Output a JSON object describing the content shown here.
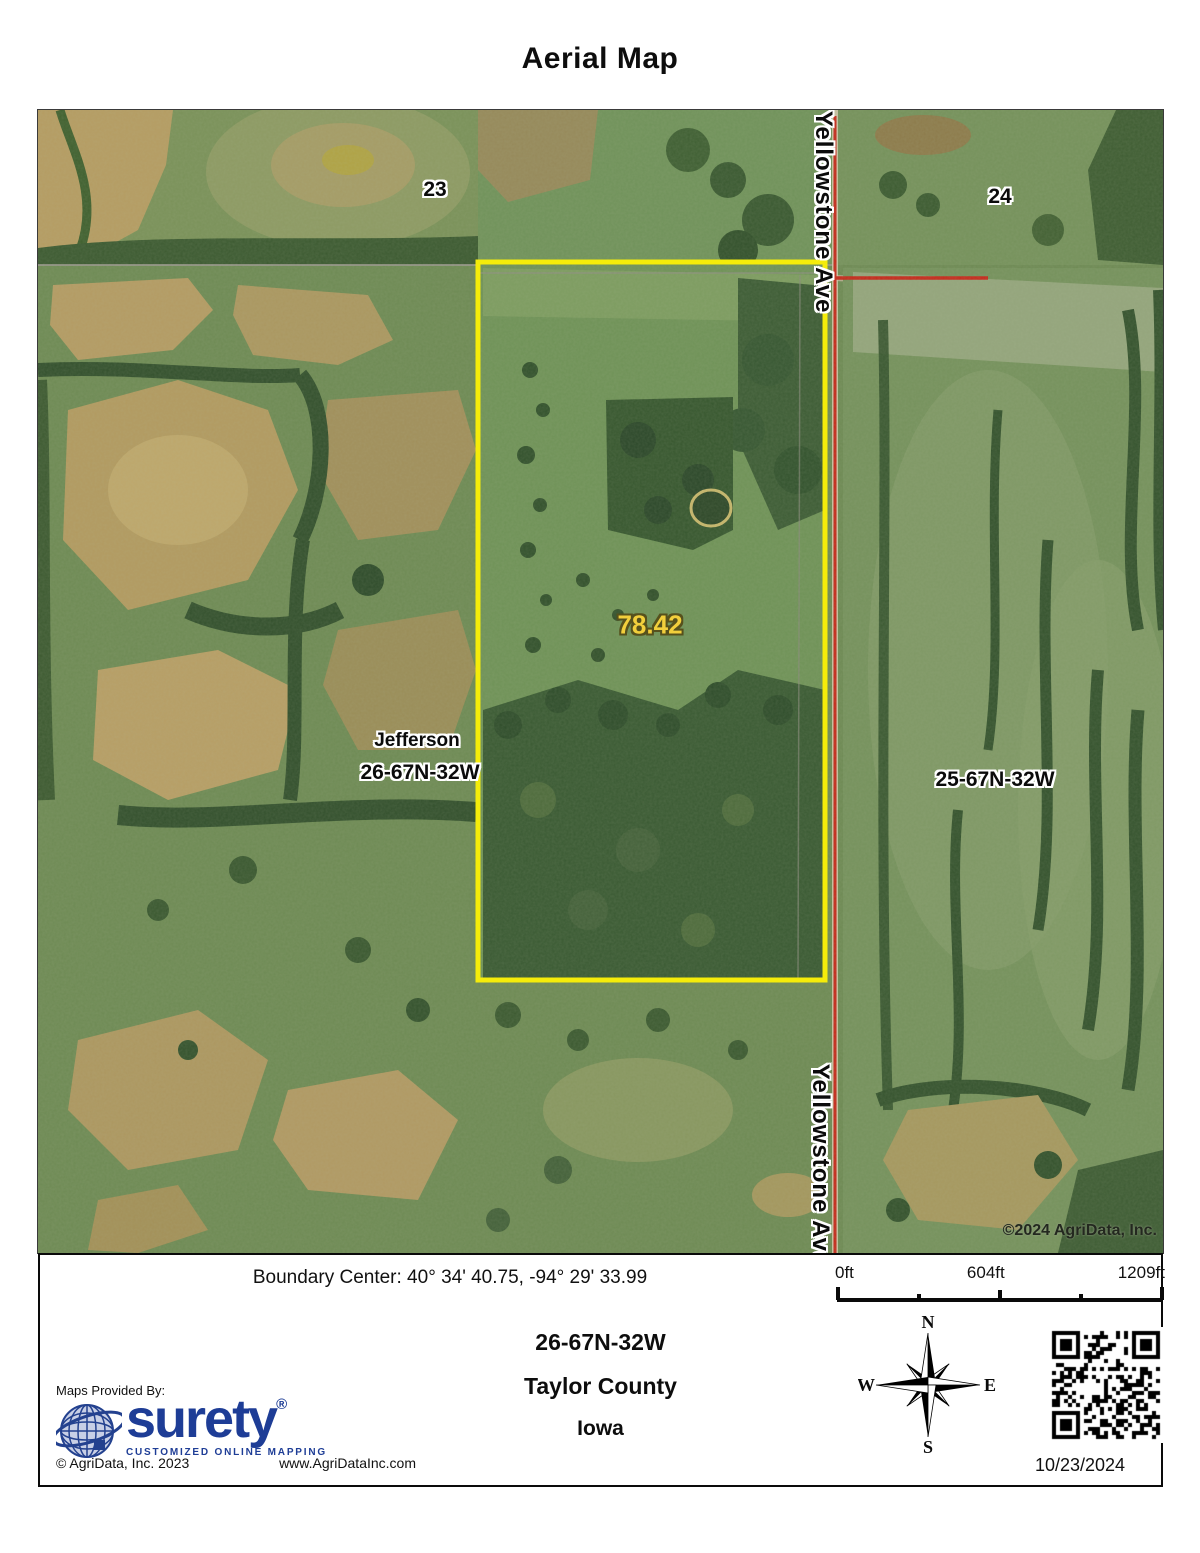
{
  "title": "Aerial Map",
  "map": {
    "labels": {
      "section_left": "23",
      "section_right": "24",
      "road_top": "Yellowstone Ave",
      "road_bottom": "Yellowstone Ave",
      "acreage": "78.42",
      "township_name": "Jefferson",
      "trs_left": "26-67N-32W",
      "trs_right": "25-67N-32W",
      "copyright": "©2024 AgriData, Inc."
    },
    "colors": {
      "boundary": "#f5ec0a",
      "road": "#c52a1c",
      "acreage_text": "#f2cf3c"
    }
  },
  "footer": {
    "boundary_center": "Boundary Center: 40° 34' 40.75,  -94° 29' 33.99",
    "scale": {
      "start": "0ft",
      "mid": "604ft",
      "end": "1209ft"
    },
    "location": {
      "trs": "26-67N-32W",
      "county": "Taylor County",
      "state": "Iowa"
    },
    "provider": {
      "maps_provided_by": "Maps Provided By:",
      "brand": "surety",
      "registered": "®",
      "tagline": "CUSTOMIZED ONLINE MAPPING",
      "copyright": "© AgriData, Inc. 2023",
      "website": "www.AgriDataInc.com"
    },
    "compass": {
      "n": "N",
      "e": "E",
      "s": "S",
      "w": "W"
    },
    "date": "10/23/2024"
  }
}
